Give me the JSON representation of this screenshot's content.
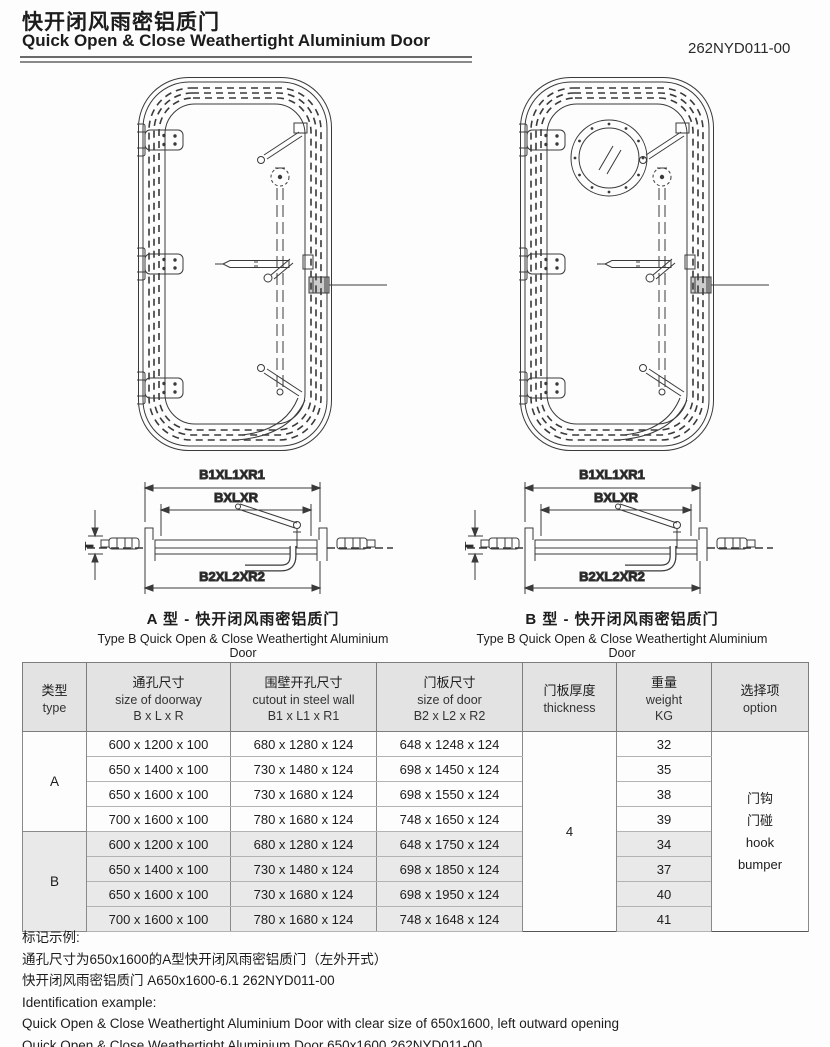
{
  "header": {
    "title_zh": "快开闭风雨密铝质门",
    "title_en": "Quick Open & Close Weathertight Aluminium Door",
    "doc_number": "262NYD011-00"
  },
  "dimensions": {
    "outer": "B1XL1XR1",
    "middle": "BXLXR",
    "bottom": "B2XL2XR2",
    "thickness": "T"
  },
  "figures": {
    "left": {
      "caption_zh": "A 型 - 快开闭风雨密铝质门",
      "caption_en": "Type B Quick Open & Close Weathertight Aluminium Door"
    },
    "right": {
      "caption_zh": "B 型 - 快开闭风雨密铝质门",
      "caption_en": "Type B Quick Open & Close Weathertight Aluminium Door"
    }
  },
  "table": {
    "headers": {
      "type_zh": "类型",
      "type_en": "type",
      "doorway_zh": "通孔尺寸",
      "doorway_en": "size of doorway",
      "doorway_formula": "B x L x R",
      "cutout_zh": "围壁开孔尺寸",
      "cutout_en": "cutout in steel wall",
      "cutout_formula": "B1 x L1 x R1",
      "door_zh": "门板尺寸",
      "door_en": "size of door",
      "door_formula": "B2 x L2 x R2",
      "thickness_zh": "门板厚度",
      "thickness_en": "thickness",
      "weight_zh": "重量",
      "weight_en": "weight",
      "weight_unit": "KG",
      "option_zh": "选择项",
      "option_en": "option"
    },
    "thickness": "4",
    "options": [
      "门钩",
      "门碰",
      "hook",
      "bumper"
    ],
    "groups": [
      {
        "type": "A",
        "rows": [
          [
            "600 x 1200 x 100",
            "680 x 1280 x 124",
            "648 x 1248 x 124",
            "32"
          ],
          [
            "650 x 1400 x 100",
            "730 x 1480 x 124",
            "698 x 1450 x 124",
            "35"
          ],
          [
            "650 x 1600 x 100",
            "730 x 1680 x 124",
            "698 x 1550 x 124",
            "38"
          ],
          [
            "700 x 1600 x 100",
            "780 x 1680 x 124",
            "748 x 1650 x 124",
            "39"
          ]
        ]
      },
      {
        "type": "B",
        "rows": [
          [
            "600 x 1200 x 100",
            "680 x 1280 x 124",
            "648 x 1750 x 124",
            "34"
          ],
          [
            "650 x 1400 x 100",
            "730 x 1480 x 124",
            "698 x 1850 x 124",
            "37"
          ],
          [
            "650 x 1600 x 100",
            "730 x 1680 x 124",
            "698 x 1950 x 124",
            "40"
          ],
          [
            "700 x 1600 x 100",
            "780 x 1680 x 124",
            "748 x 1648 x 124",
            "41"
          ]
        ]
      }
    ]
  },
  "footer": {
    "line1": "标记示例:",
    "line2": "通孔尺寸为650x1600的A型快开闭风雨密铝质门（左外开式）",
    "line3": "快开闭风雨密铝质门 A650x1600-6.1 262NYD011-00",
    "line4": "Identification example:",
    "line5": "Quick Open & Close Weathertight Aluminium Door with clear size of 650x1600, left outward opening",
    "line6": "Quick Open & Close Weathertight Aluminium Door 650x1600 262NYD011-00"
  }
}
